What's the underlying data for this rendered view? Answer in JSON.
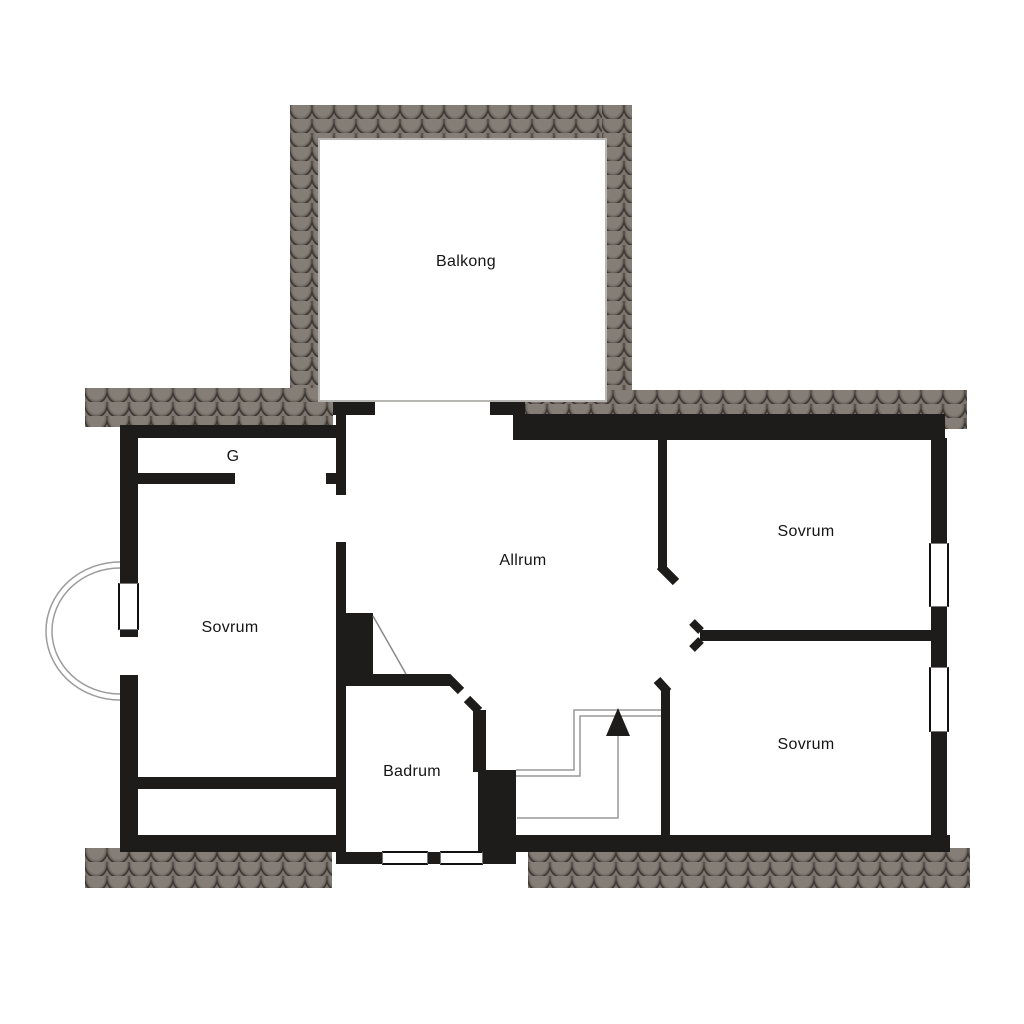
{
  "title": "Floor plan",
  "rooms": {
    "balkong": "Balkong",
    "closet": "G",
    "sovrum_left": "Sovrum",
    "allrum": "Allrum",
    "sovrum_top_right": "Sovrum",
    "sovrum_bottom_right": "Sovrum",
    "badrum": "Badrum"
  },
  "symbols": {
    "stairs_direction": "up-arrow",
    "entry_arc": "semicircular-step",
    "fireplace": "solid-block"
  },
  "colors": {
    "wall": "#1d1c1a",
    "shingle_base": "#4e4a45",
    "shingle_light": "#857e76",
    "shingle_outline": "#2c2927",
    "thin_line": "#9c9c9c",
    "balcony_border": "#b8b6b3",
    "background": "#ffffff",
    "text": "#151515"
  }
}
